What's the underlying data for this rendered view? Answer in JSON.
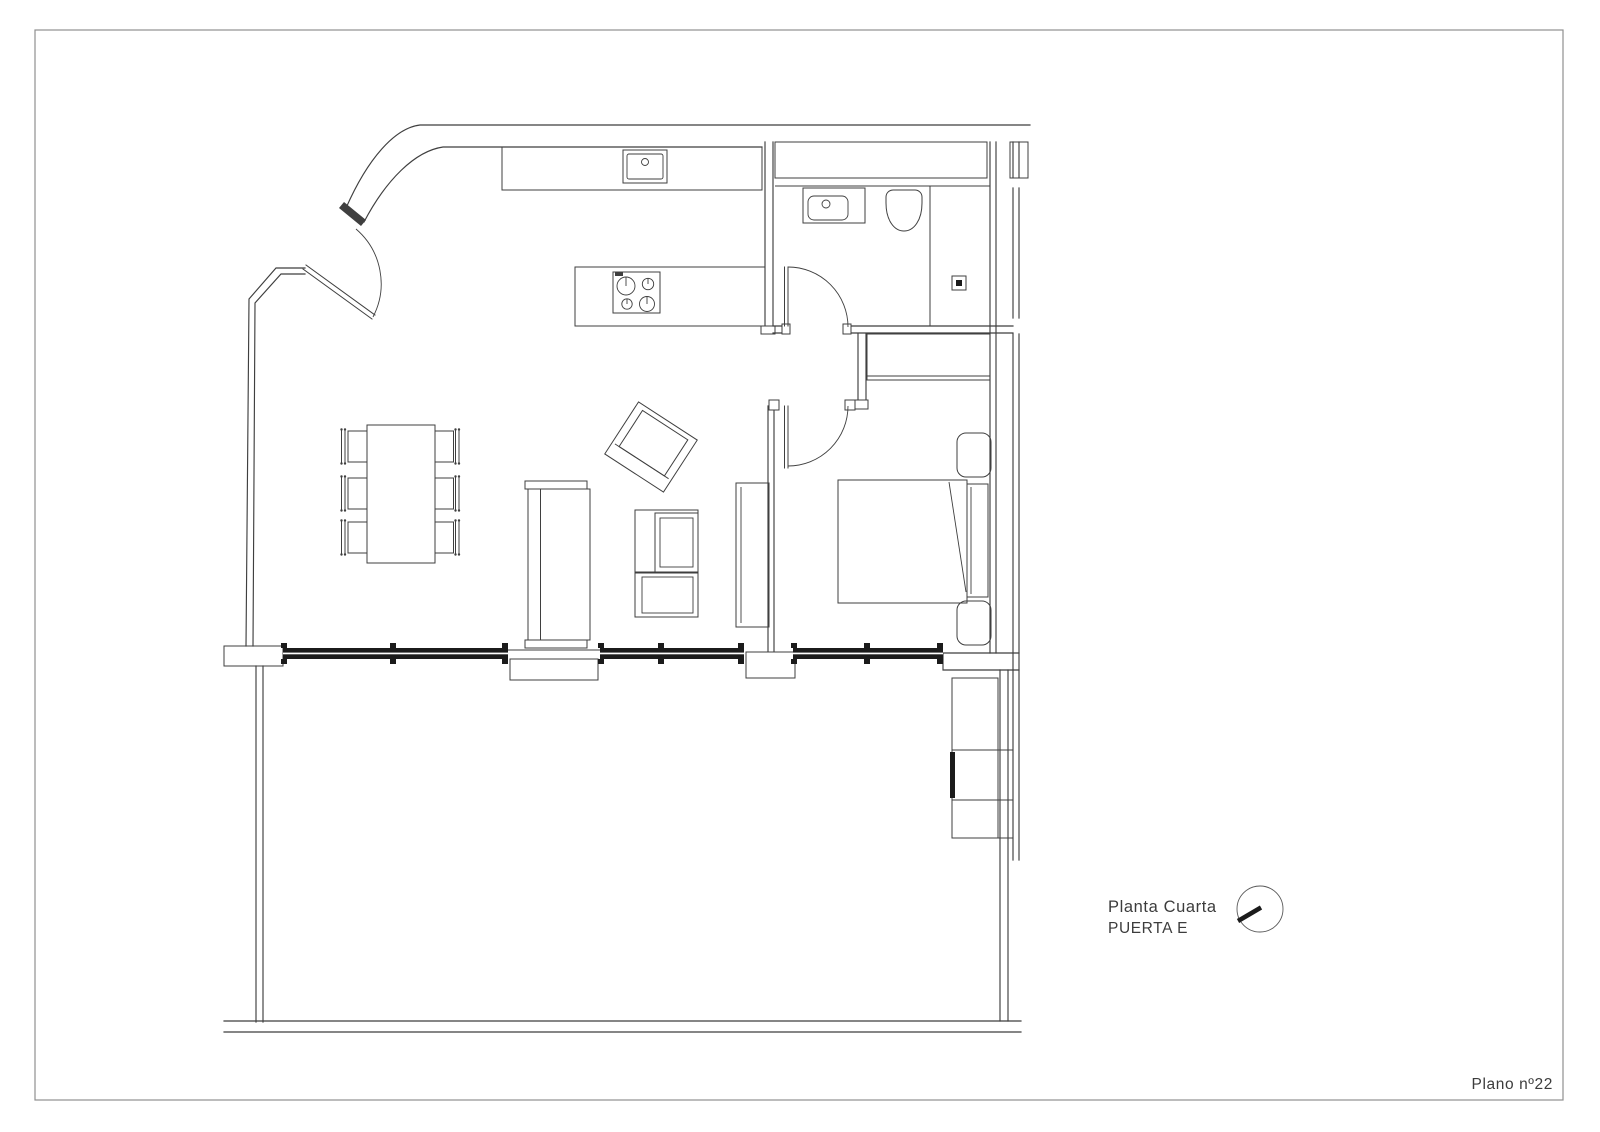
{
  "titles": {
    "plan_title_line1": "Planta Cuarta",
    "plan_title_line2": "PUERTA E",
    "sheet_label": "Plano nº22"
  },
  "icons": {
    "north_indicator": "north-arrow-icon"
  },
  "theme": {
    "line": "#3f3f3f",
    "line_light": "#8f8f8f",
    "window_fill": "#1b1b1b",
    "text": "#3c3c3c",
    "paper": "#ffffff",
    "bg": "#fbfbfa"
  }
}
